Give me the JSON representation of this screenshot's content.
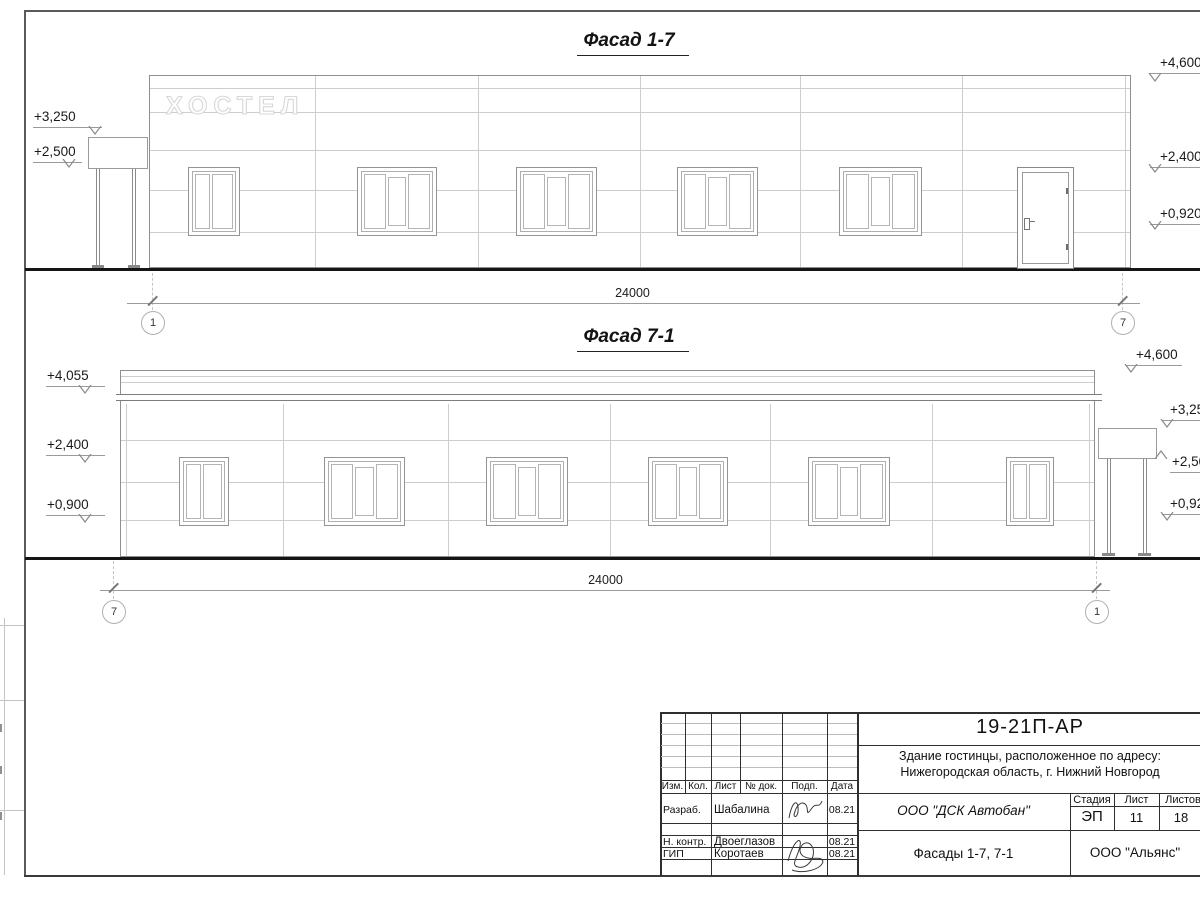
{
  "sheet": {
    "facade_top": {
      "title": "Фасад 1-7",
      "sign": "ХОСТЕЛ",
      "marks_left": [
        {
          "v": "+3,250"
        },
        {
          "v": "+2,500"
        }
      ],
      "marks_right": [
        {
          "v": "+4,600"
        },
        {
          "v": "+2,400"
        },
        {
          "v": "+0,920"
        }
      ],
      "dim": "24000",
      "axis_l": "1",
      "axis_r": "7"
    },
    "facade_bottom": {
      "title": "Фасад 7-1",
      "marks_left": [
        {
          "v": "+4,055"
        },
        {
          "v": "+2,400"
        },
        {
          "v": "+0,900"
        }
      ],
      "marks_right": [
        {
          "v": "+4,600"
        },
        {
          "v": "+3,250"
        },
        {
          "v": "+2,500"
        },
        {
          "v": "+0,920"
        }
      ],
      "dim": "24000",
      "axis_l": "7",
      "axis_r": "1"
    },
    "stamp": {
      "doc": "19-21П-АР",
      "addr1": "Здание гостинцы, расположенное по адресу:",
      "addr2": "Нижегородская область, г. Нижний Новгород",
      "cols": {
        "izm": "Изм.",
        "kol": "Кол.",
        "list": "Лист",
        "ndoc": "№ док.",
        "podp": "Подп.",
        "date": "Дата"
      },
      "rows": [
        {
          "role": "Разраб.",
          "name": "Шабалина",
          "date": "08.21"
        },
        {
          "role": "Н. контр.",
          "name": "Двоеглазов",
          "date": "08.21"
        },
        {
          "role": "ГИП",
          "name": "Коротаев",
          "date": "08.21"
        }
      ],
      "company": "ООО \"ДСК Автобан\"",
      "sheet_title": "Фасады 1-7, 7-1",
      "stage_label": "Стадия",
      "stage": "ЭП",
      "list_label": "Лист",
      "list": "11",
      "listov_label": "Листов",
      "listov": "18",
      "firm": "ООО \"Альянс\""
    }
  }
}
